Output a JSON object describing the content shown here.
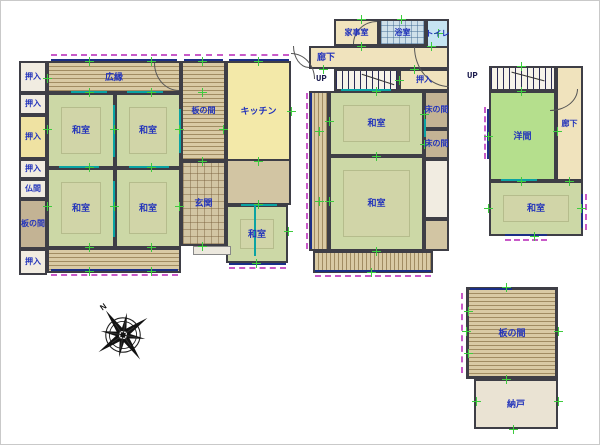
{
  "rooms": {
    "oshiire": "押入",
    "butsuma": "仏間",
    "itanoma": "板の間",
    "hiroen": "広縁",
    "washitsu": "和室",
    "kitchen": "キッチン",
    "genkan": "玄関",
    "kajishitsu": "家事室",
    "yokushitsu": "浴室",
    "toilet": "トイレ",
    "rouka": "廊下",
    "up": "UP",
    "tokonoma": "床の間",
    "youma": "洋間",
    "nando": "納戸"
  },
  "compass": {
    "north_label": "N"
  },
  "colors": {
    "tatami": "#ccd8a6",
    "tatami_inner": "#d8d2ab",
    "wood": "#d9caa4",
    "wood_line": "#a18c62",
    "kitchen": "#f3e9a9",
    "corridor": "#f0e3bd",
    "tan": "#d2c5a3",
    "closet": "#f1ece1",
    "closet_yellow": "#efe2a2",
    "brown": "#c3b394",
    "bath": "#cfe0ea",
    "toilet": "#c6e4f2",
    "youma": "#b5df8d",
    "nando": "#eae3d3",
    "wall": "#3e3e46",
    "label": "#2233bb",
    "window": "#1b2f86",
    "dashc": "#c85ac8",
    "tick": "#3ecc3e",
    "teal": "#0aa3a3"
  }
}
